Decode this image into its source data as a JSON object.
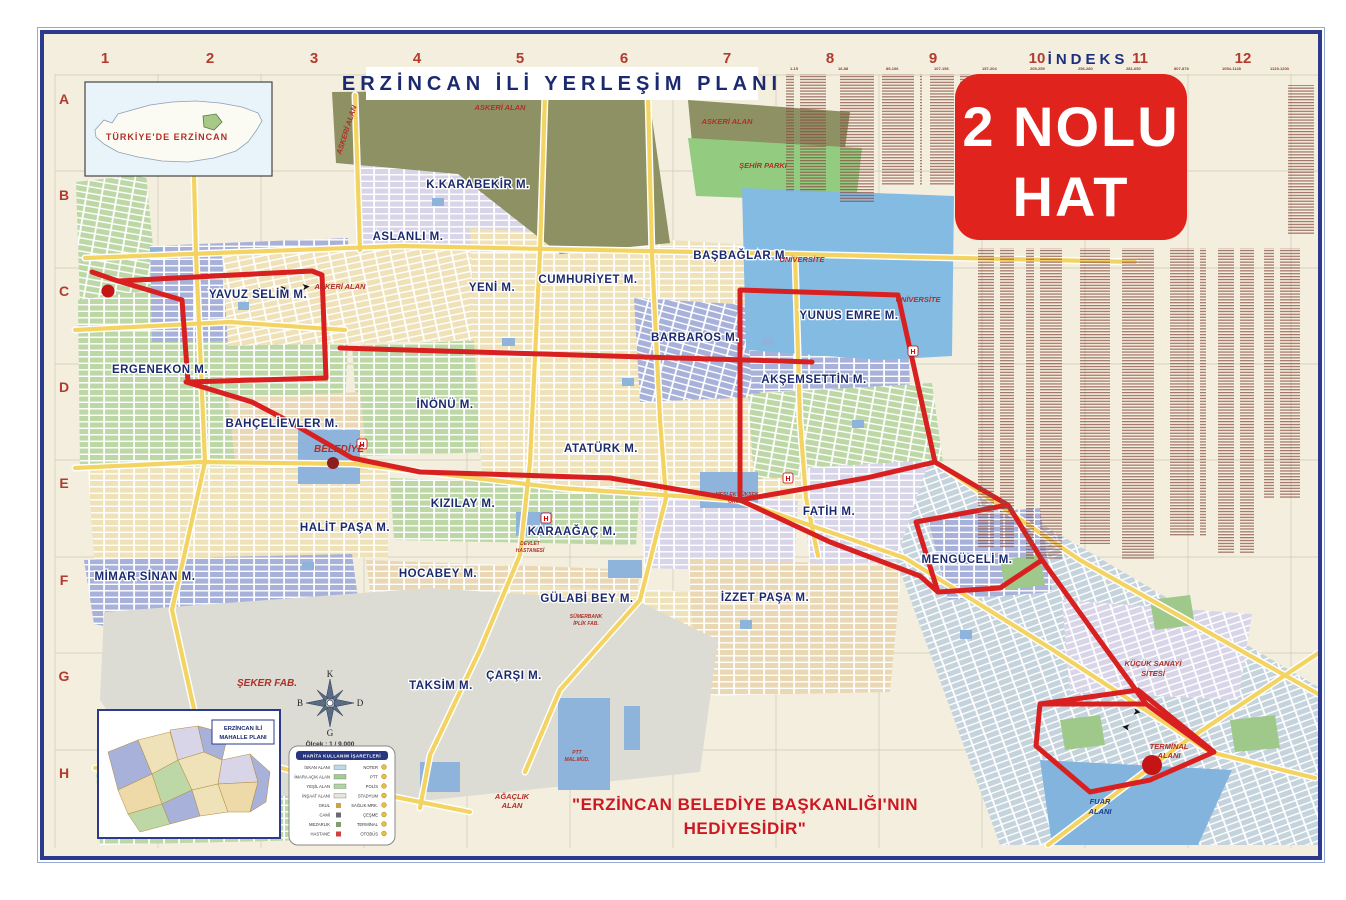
{
  "page": {
    "title": "ERZİNCAN İLİ YERLEŞİM PLANI"
  },
  "badge": {
    "line1": "2 NOLU",
    "line2": "HAT",
    "color": "#e0231c"
  },
  "index": {
    "title": "İNDEKS",
    "column_headers": [
      "1-15",
      "16-88",
      "89-106",
      "107-156",
      "157-204",
      "205-255",
      "256-280",
      "281-650",
      "807-878",
      "1054-1128",
      "1129-1203"
    ]
  },
  "grid": {
    "cols": [
      "1",
      "2",
      "3",
      "4",
      "5",
      "6",
      "7",
      "8",
      "9",
      "10",
      "11",
      "12"
    ],
    "rows": [
      "A",
      "B",
      "C",
      "D",
      "E",
      "F",
      "G",
      "H"
    ]
  },
  "insets": {
    "turkey": {
      "label": "TÜRKİYE'DE ERZİNCAN"
    },
    "mahalle": {
      "line1": "ERZİNCAN İLİ",
      "line2": "MAHALLE PLANI"
    }
  },
  "compass": {
    "n": "K",
    "e": "D",
    "s": "G",
    "w": "B",
    "scale": "Ölçek : 1 / 9.000"
  },
  "legend": {
    "title": "HARİTA KULLANIM İŞARETLERİ",
    "left": [
      {
        "label": "İSKAN ALANI",
        "sw": "#bcd9ea"
      },
      {
        "label": "İMARA AÇIK ALAN",
        "sw": "#9fcf8f"
      },
      {
        "label": "YEŞİL ALAN",
        "sw": "#aed6a0"
      },
      {
        "label": "İNŞAAT ALANI",
        "sw": "#e6e6dc"
      },
      {
        "label": "OKUL",
        "sw": "#caa24a"
      },
      {
        "label": "CAMİ",
        "sw": "#6b6b6b"
      },
      {
        "label": "MEZARLIK",
        "sw": "#7f9f6f"
      },
      {
        "label": "HASTANE",
        "sw": "#d04040"
      }
    ],
    "right": [
      {
        "label": "NOTER"
      },
      {
        "label": "PTT"
      },
      {
        "label": "POLİS"
      },
      {
        "label": "STADYUM"
      },
      {
        "label": "SAĞLIK MRK."
      },
      {
        "label": "ÇEŞME"
      },
      {
        "label": "TERMİNAL"
      },
      {
        "label": "OTOBÜS"
      }
    ]
  },
  "footer": {
    "line1": "\"ERZİNCAN BELEDİYE BAŞKANLIĞI'NIN",
    "line2": "HEDİYESİDİR\""
  },
  "map": {
    "neighborhoods": [
      "K.KARABEKİR M.",
      "ASLANLI M.",
      "YENİ M.",
      "CUMHURİYET M.",
      "BAŞBAĞLAR M.",
      "YUNUS EMRE M.",
      "BARBAROS M.",
      "AKŞEMSETTİN M.",
      "İNÖNÜ M.",
      "ATATÜRK M.",
      "ERGENEKON M.",
      "YAVUZ SELİM M.",
      "BAHÇELİEVLER M.",
      "KIZILAY M.",
      "HALİT PAŞA M.",
      "KARAAĞAÇ M.",
      "FATİH M.",
      "MENGÜCELİ M.",
      "İZZET PAŞA M.",
      "MİMAR SİNAN M.",
      "HOCABEY M.",
      "GÜLABİ BEY M.",
      "ÇARŞI M.",
      "TAKSİM M."
    ],
    "area_labels": [
      "ASKERİ ALAN",
      "ASKERİ ALAN",
      "ASKERİ ALAN",
      "ASKERİ ALAN",
      "ŞEHİR PARKI",
      "ÜNİVERSİTE",
      "ÜNİVERSİTE",
      "BELEDİYE",
      "MESLEK YÜKSEK",
      "OKULU",
      "ŞEKER FAB.",
      "SÜMERBANK",
      "İPLİK FAB.",
      "KÜÇÜK SANAYİ",
      "SİTESİ",
      "TERMİNAL",
      "ALANI",
      "FUAR",
      "ALANI",
      "AĞAÇLIK",
      "ALAN",
      "PTT",
      "MAL.MÜD.",
      "DEVLET",
      "HASTANESİ"
    ],
    "hospital_icon": "H",
    "colors": {
      "route_red": "#d92020",
      "road_yellow": "#f3d463",
      "military_olive": "#8e9163",
      "water_blue": "#84bbe2",
      "sheet_cream": "#f3eedd",
      "frame_navy": "#2b3a8c"
    }
  }
}
